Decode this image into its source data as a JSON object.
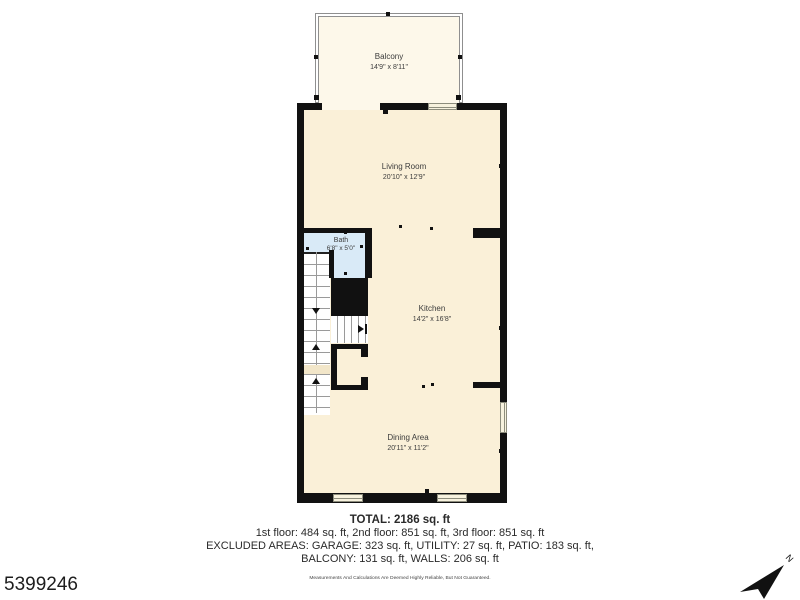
{
  "listing_id": "5399246",
  "compass": {
    "label": "N"
  },
  "floorplan": {
    "rooms": [
      {
        "name": "Balcony",
        "dimensions": "14'9\" x 8'11\""
      },
      {
        "name": "Living Room",
        "dimensions": "20'10\" x 12'9\""
      },
      {
        "name": "Bath",
        "dimensions": "6'8\" x 5'0\""
      },
      {
        "name": "Kitchen",
        "dimensions": "14'2\" x 16'8\""
      },
      {
        "name": "Dining Area",
        "dimensions": "20'11\" x 11'2\""
      }
    ],
    "colors": {
      "floor": "#faf0d8",
      "balcony_floor": "#fdf8ea",
      "bath": "#d9eaf7",
      "wall": "#111111"
    }
  },
  "summary": {
    "total": "TOTAL: 2186 sq. ft",
    "floors": "1st floor: 484 sq. ft, 2nd floor: 851 sq. ft, 3rd floor: 851 sq. ft",
    "excluded_line1": "EXCLUDED AREAS: GARAGE: 323 sq. ft, UTILITY: 27 sq. ft, PATIO: 183 sq. ft,",
    "excluded_line2": "BALCONY: 131 sq. ft, WALLS: 206 sq. ft",
    "disclaimer": "Measurements And Calculations Are Deemed Highly Reliable, But Not Guaranteed."
  }
}
